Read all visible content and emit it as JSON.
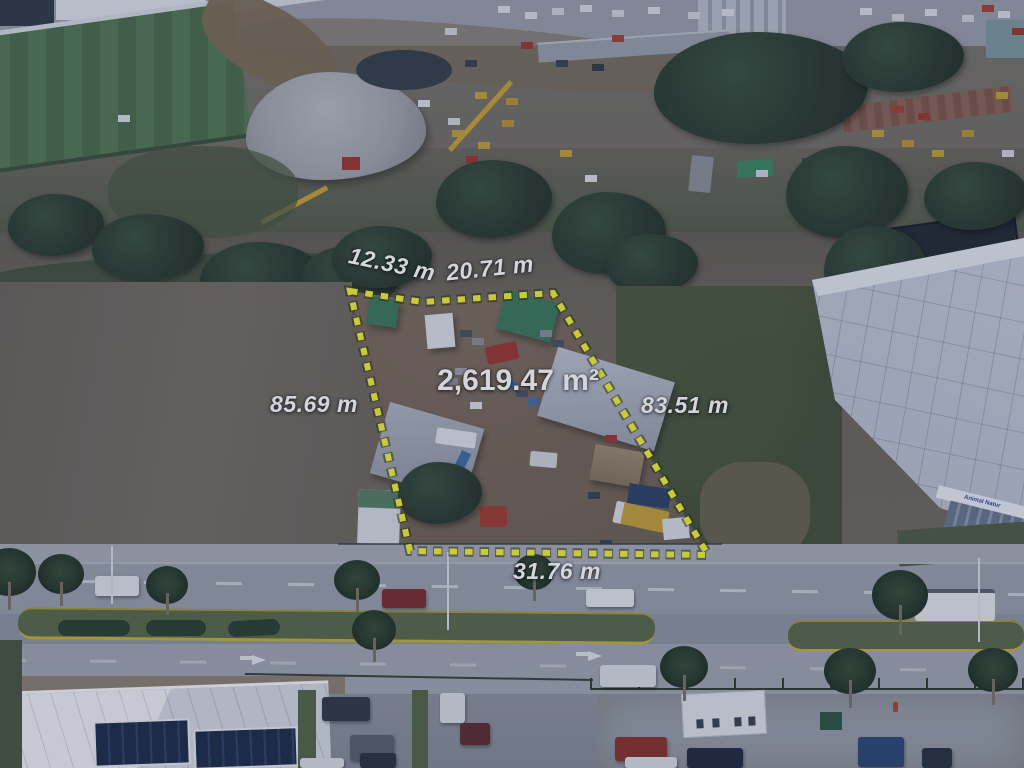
{
  "annotation": {
    "area_label": "2,619.47 m²",
    "side_top_left": "12.33 m",
    "side_top_right": "20.71 m",
    "side_left": "85.69 m",
    "side_right": "83.51 m",
    "side_bottom": "31.76 m",
    "outline_color": "#eef23c",
    "label_color": "#ffffff"
  },
  "scene": {
    "building_sign": "Animal Natur"
  }
}
